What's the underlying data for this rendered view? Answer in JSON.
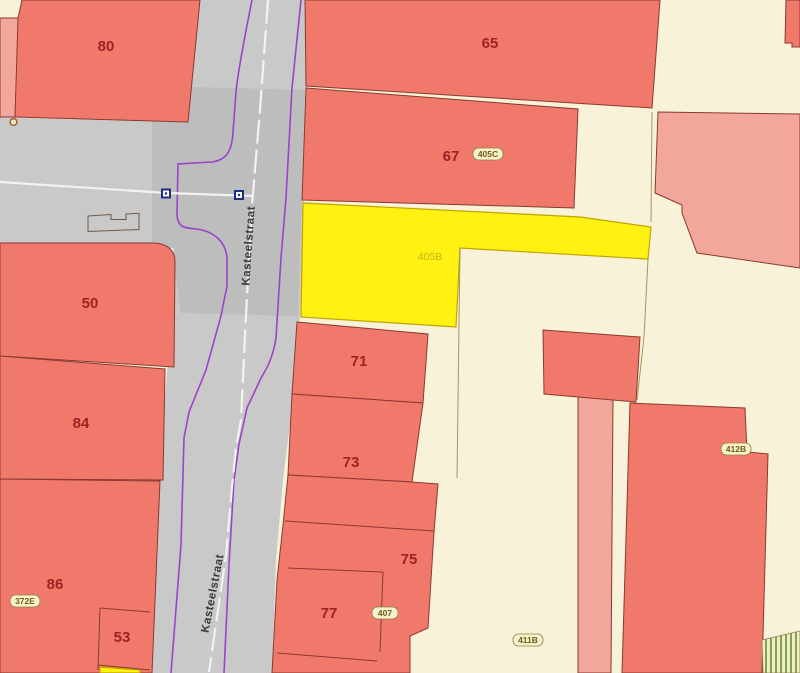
{
  "map": {
    "street_labels": [
      "Kasteelstraat",
      "Kasteelstraat"
    ],
    "house_numbers": [
      "80",
      "65",
      "67",
      "50",
      "84",
      "86",
      "53",
      "71",
      "73",
      "75",
      "77"
    ],
    "parcel_tags": [
      "405C",
      "372E",
      "407",
      "411B",
      "412B"
    ],
    "highlighted_parcel": {
      "label": "405B"
    },
    "colors": {
      "building-fill": "#f1796c",
      "building-stroke": "#8a392f",
      "building-light-fill": "#f3a79c",
      "parcel-fill": "#f8f2d8",
      "parcel-stroke": "#a3965c",
      "road-fill": "#c9c9c9",
      "boundary-purple": "#9c43c9",
      "road-line-white": "#f2f2f0",
      "marker-blue": "#1b2e7f",
      "marker-brown": "#a8622a",
      "highlight-fill": "#fff212",
      "highlight-stroke": "#c2a300",
      "highlight-text": "#c9b414",
      "number-text": "#9e2222",
      "street-text": "#3a3a3a",
      "tag-fill": "#f7f0cc",
      "tag-stroke": "#8f8040",
      "tag-text": "#6f5f17",
      "hatch-green": "#7fa351"
    }
  }
}
